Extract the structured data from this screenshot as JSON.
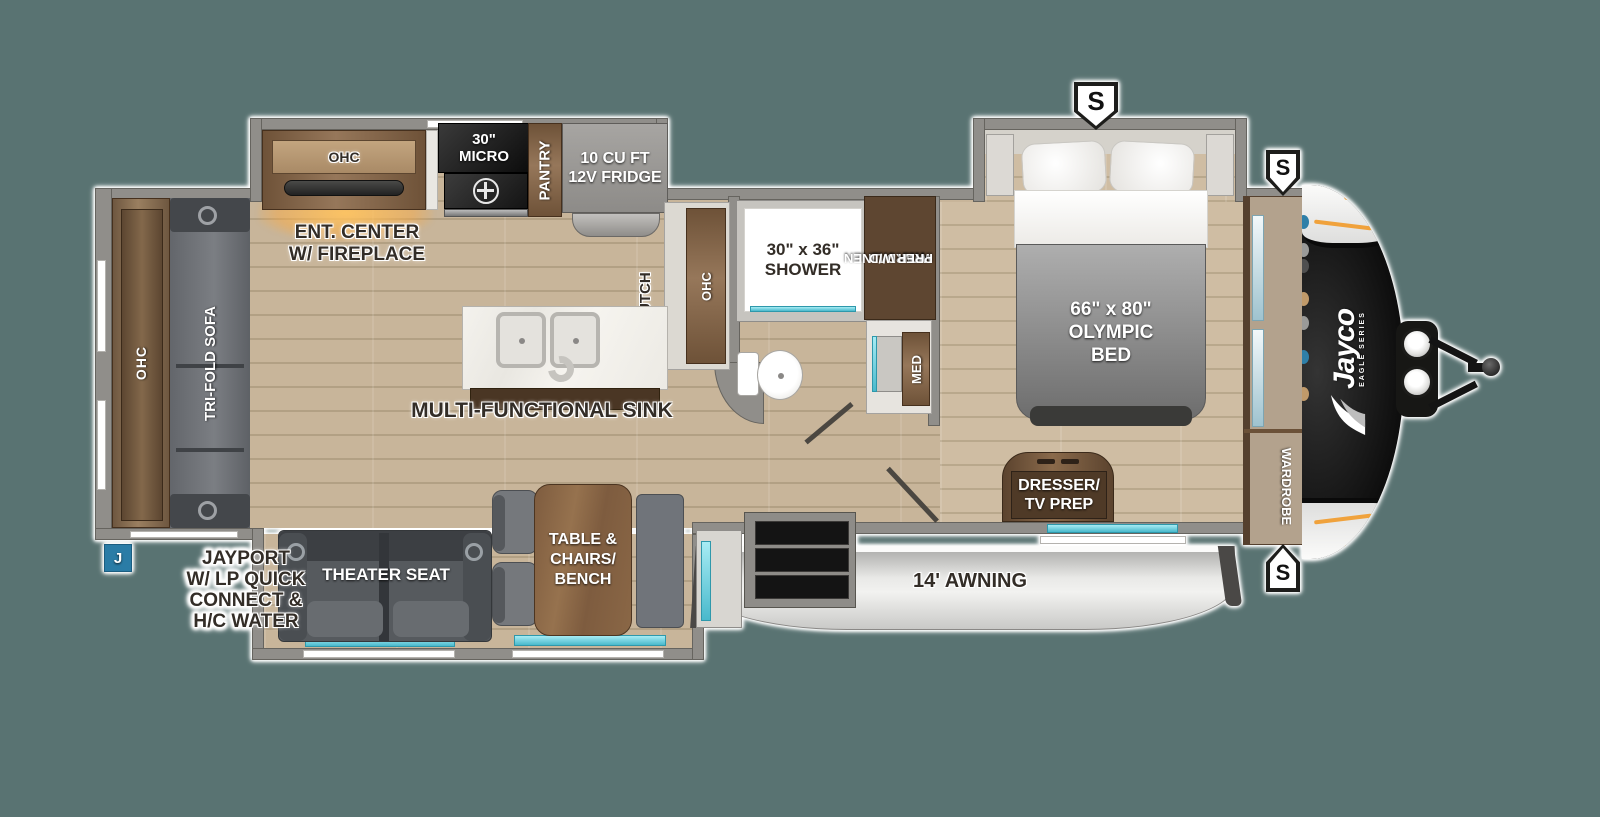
{
  "badges": {
    "top_spare": "S",
    "front_upper_spare": "S",
    "front_lower_spare": "S",
    "jayport_marker": "J"
  },
  "labels": {
    "rear_ohc": "OHC",
    "tri_fold_sofa": "TRI-FOLD SOFA",
    "ent_center": [
      "ENT. CENTER",
      "W/ FIREPLACE"
    ],
    "kitchen_ohc": "OHC",
    "micro": [
      "30\"",
      "MICRO"
    ],
    "pantry": "PANTRY",
    "fridge": [
      "10 CU FT",
      "12V FRIDGE"
    ],
    "hutch": "HUTCH",
    "hutch_ohc": "OHC",
    "shower": [
      "30\" x 36\"",
      "SHOWER"
    ],
    "ward_linen": [
      "WARD/LINEN",
      "WITH W/D",
      "PREP"
    ],
    "med": "MED",
    "olympic_bed": [
      "66\" x 80\"",
      "OLYMPIC",
      "BED"
    ],
    "multi_sink": "MULTI-FUNCTIONAL SINK",
    "dresser": [
      "DRESSER/",
      "TV PREP"
    ],
    "wardrobe": "WARDROBE",
    "theater_seat": "THEATER SEAT",
    "dinette": [
      "TABLE &",
      "CHAIRS/",
      "BENCH"
    ],
    "awning": "14' AWNING",
    "jayport": [
      "JAYPORT",
      "W/ LP QUICK",
      "CONNECT &",
      "H/C WATER"
    ]
  },
  "brand": {
    "name": "Jayco",
    "series": "EAGLE SERIES"
  },
  "colors": {
    "background": "#597372",
    "wall_gray": "#908e8a",
    "floor_tan": "#c8b59a",
    "cabinet_wood": "#7b5f45",
    "dark_wood": "#5e4631",
    "appliance_dark": "#1e1e1e",
    "window_teal": "#62cede",
    "awning_gray": "#e9e9e7",
    "badge_blue": "#2a7ca6",
    "front_cap_black": "#141414",
    "accent_orange": "#f0a23c"
  }
}
